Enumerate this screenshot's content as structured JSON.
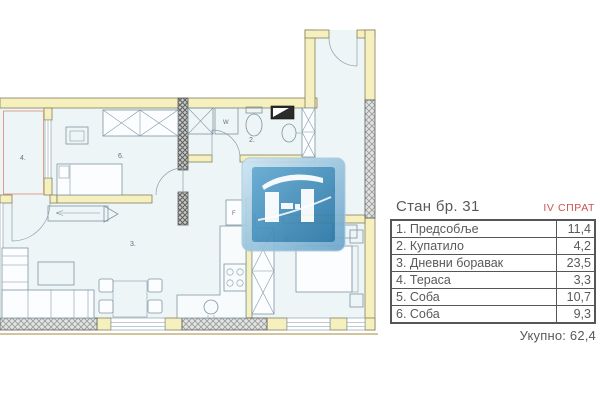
{
  "colors": {
    "accent_red": "#c9524e",
    "wall_fill": "#f5f0bd",
    "floor_fill": "#eef5f6",
    "logo_blue": "#3b84b2",
    "text_gray": "#58595b"
  },
  "plan": {
    "room_labels": {
      "hall": "1.",
      "bathroom": "2.",
      "living": "3.",
      "terrace": "4.",
      "bedroom5": "5.",
      "bedroom6": "6."
    },
    "appliance_labels": {
      "washer": "W",
      "fridge": "F"
    }
  },
  "panel": {
    "title": "Стан бр. 31",
    "floor": "IV СПРАТ",
    "rows": [
      {
        "name": "1. Предсобље",
        "area": "11,4"
      },
      {
        "name": "2. Купатило",
        "area": "4,2"
      },
      {
        "name": "3. Дневни боравак",
        "area": "23,5"
      },
      {
        "name": "4. Тераса",
        "area": "3,3"
      },
      {
        "name": "5. Соба",
        "area": "10,7"
      },
      {
        "name": "6. Соба",
        "area": "9,3"
      }
    ],
    "total": "Укупно: 62,4"
  }
}
